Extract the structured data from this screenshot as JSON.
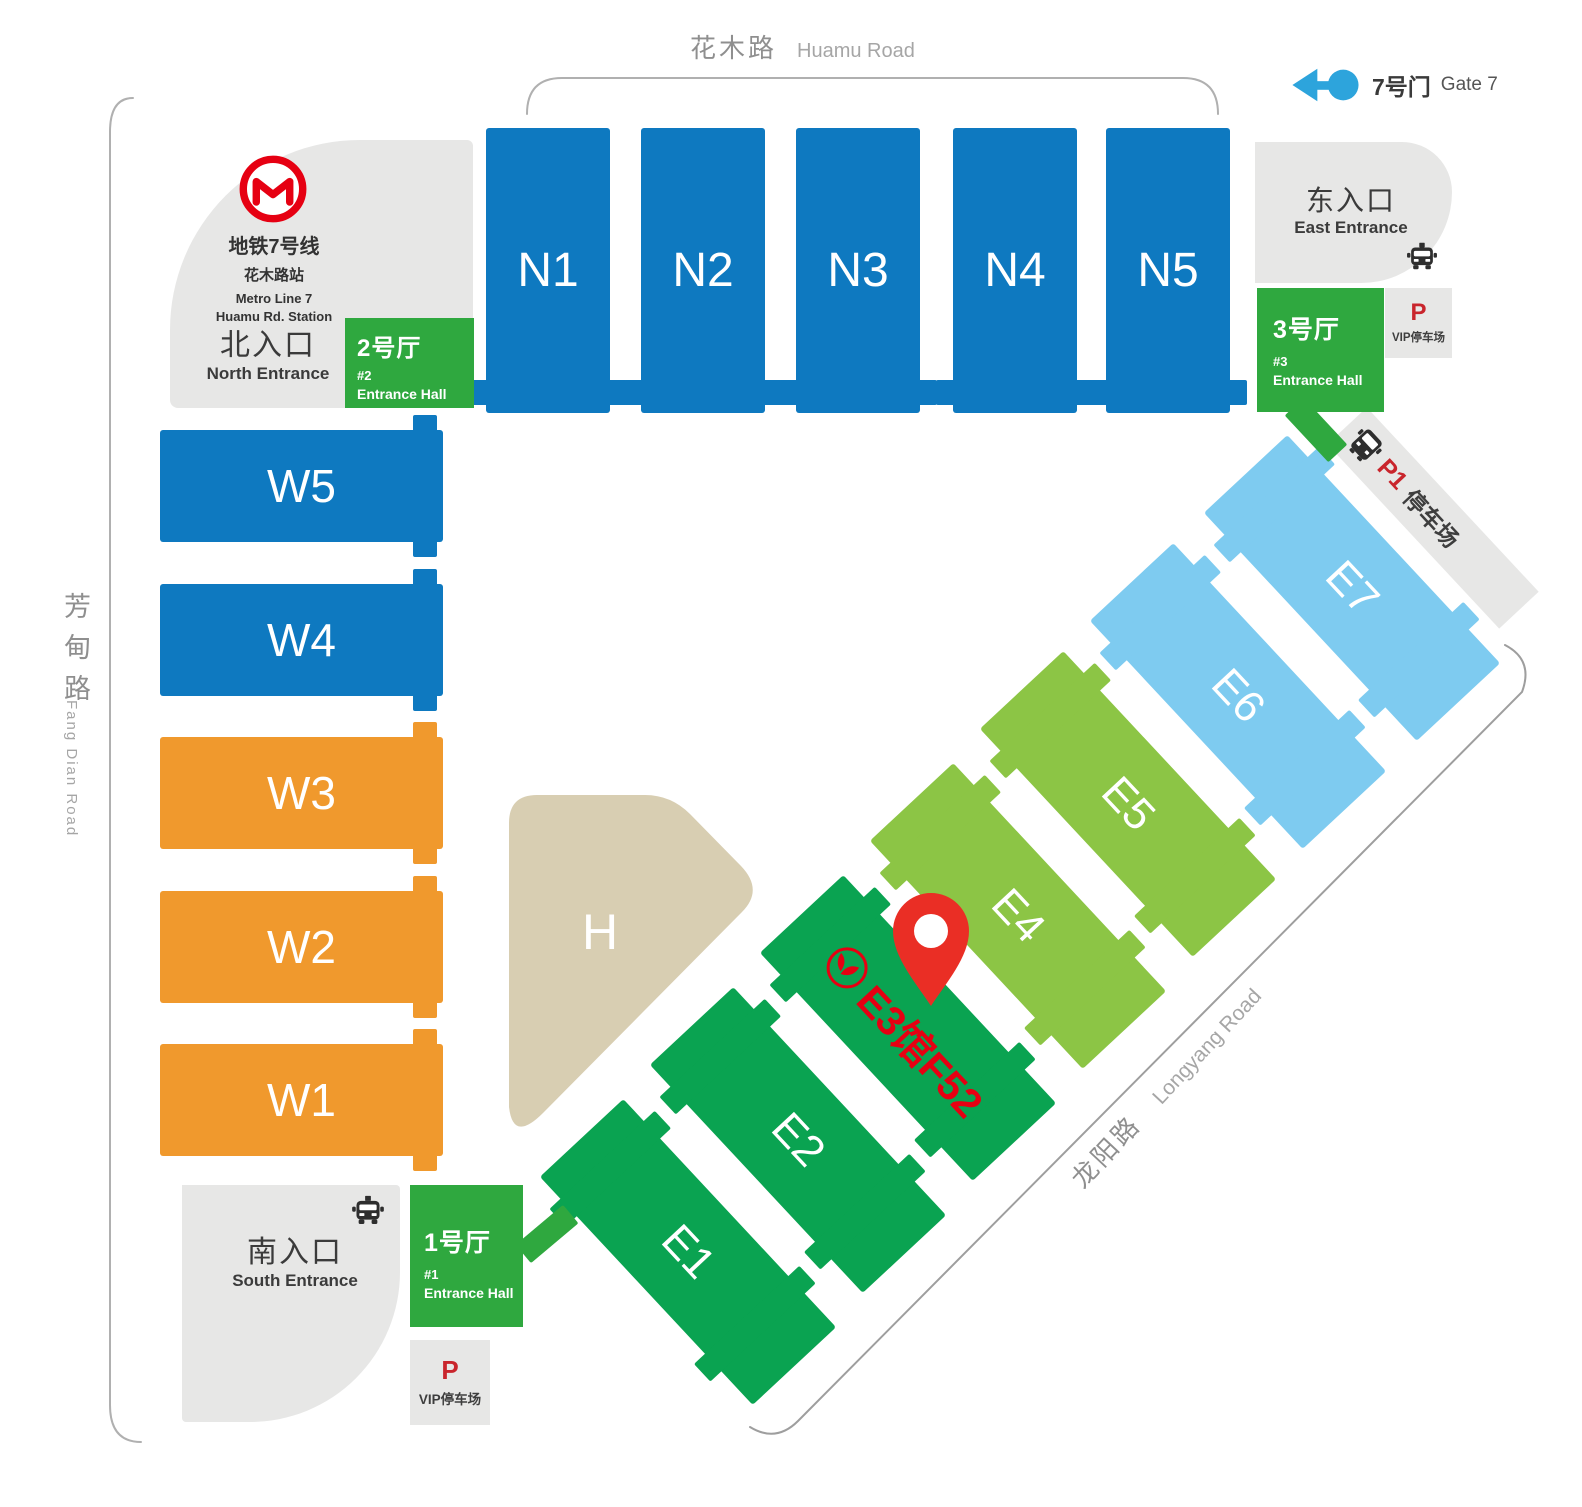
{
  "palette": {
    "blue": "#0e79c0",
    "orange": "#f0992d",
    "dgreen": "#0aa351",
    "lgreen": "#8cc545",
    "lblue": "#7ecbf0",
    "egreen": "#2fa83f",
    "beige": "#d8ceb2",
    "grayarea": "#e7e7e6",
    "red": "#e60012",
    "pred": "#c9252c",
    "pinred": "#ea2e25",
    "gateblue": "#2da4dc",
    "roadline": "#b0b0b0",
    "textdark": "#3b3b3b",
    "textgray": "#979797"
  },
  "roads": {
    "huamu": {
      "zh": "花木路",
      "en": "Huamu Road"
    },
    "fangdian": {
      "zh": "芳甸路",
      "en": "Fang Dian Road"
    },
    "longyang": {
      "zh": "龙阳路",
      "en": "Longyang Road"
    }
  },
  "gate7": {
    "zh": "7号门",
    "en": "Gate 7"
  },
  "metro": {
    "line_zh": "地铁7号线",
    "station_zh": "花木路站",
    "line_en": "Metro Line 7",
    "station_en": "Huamu Rd. Station"
  },
  "entrances": {
    "north": {
      "zh": "北入口",
      "en": "North Entrance"
    },
    "east": {
      "zh": "东入口",
      "en": "East Entrance"
    },
    "south": {
      "zh": "南入口",
      "en": "South Entrance"
    }
  },
  "halls": {
    "n": [
      "N1",
      "N2",
      "N3",
      "N4",
      "N5"
    ],
    "w": [
      "W5",
      "W4",
      "W3",
      "W2",
      "W1"
    ],
    "e": [
      "E1",
      "E2",
      "",
      "E4",
      "E5",
      "E6",
      "E7"
    ],
    "h": "H"
  },
  "entrance_halls": {
    "h1": {
      "title": "1号厅",
      "num": "#1",
      "sub": "Entrance Hall"
    },
    "h2": {
      "title": "2号厅",
      "num": "#2",
      "sub": "Entrance Hall"
    },
    "h3": {
      "title": "3号厅",
      "num": "#3",
      "sub": "Entrance Hall"
    }
  },
  "parking": {
    "vip_east": {
      "p": "P",
      "label": "VIP停车场"
    },
    "vip_south": {
      "p": "P",
      "label": "VIP停车场"
    },
    "p1": {
      "p": "P1",
      "label": "停车场"
    }
  },
  "annotation": {
    "text": "E3馆F52"
  }
}
